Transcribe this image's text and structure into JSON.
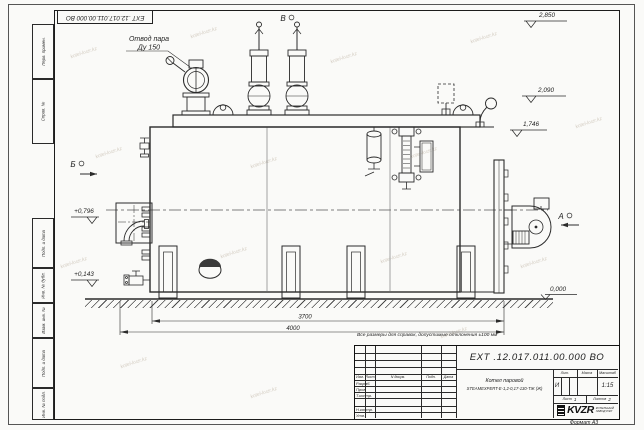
{
  "watermark": {
    "text": "kotel-kvzr.kz"
  },
  "stamp_top": "ЕХТ .12.017.011.00.000  ВО",
  "margin_labels": {
    "perv_primen": "Перв. примен.",
    "sprav_no": "Справ. №",
    "podp_data_1": "Подп. и дата",
    "inv_dubl": "Инв. № дубл.",
    "vzam_inv": "Взам. инв. №",
    "podp_data_2": "Подп. и дата",
    "inv_podl": "Инв. № подл."
  },
  "annotations": {
    "steam_outlet_line1": "Отвод пара",
    "steam_outlet_line2": "Ду 150",
    "view_top": "В",
    "view_left": "Б",
    "view_right": "А"
  },
  "elevations": {
    "e1": "2,850",
    "e2": "2,090",
    "e3": "1,746",
    "e4": "+0,796",
    "e5": "+0,143",
    "e6": "0,000"
  },
  "dimensions": {
    "d1": "3700",
    "d2": "4000"
  },
  "note": "Все размеры для справок, допустимые отклонения ±100 мм",
  "title_block": {
    "doc_number": "ЕХТ .12.017.011.00.000  ВО",
    "product_name_line1": "Котел паровой",
    "product_name_line2": "STEAMEXPERT-Е-1,2-0,17-130-ТЖ (Ж)",
    "header": {
      "izm": "Изм.",
      "list": "Лист",
      "doc": "N докум.",
      "podp": "Подп.",
      "data": "Дата"
    },
    "rows": {
      "razrab": "Разраб.",
      "prov": "Пров.",
      "tkontr": "Т.контр.",
      "nkontr": "Н.контр.",
      "utv": "Утв."
    },
    "lit_label": "Лит.",
    "massa_label": "Масса",
    "masshtab_label": "Масштаб",
    "lit_value": "И",
    "masshtab_value": "1:15",
    "list_label": "Лист",
    "list_value": "1",
    "listov_label": "Листов",
    "listov_value": "2",
    "logo_text": "KVZR",
    "logo_sub1": "КОТЕЛЬНЫЙ",
    "logo_sub2": "ЗАВОД РЭП",
    "format_label": "Формат А3"
  }
}
